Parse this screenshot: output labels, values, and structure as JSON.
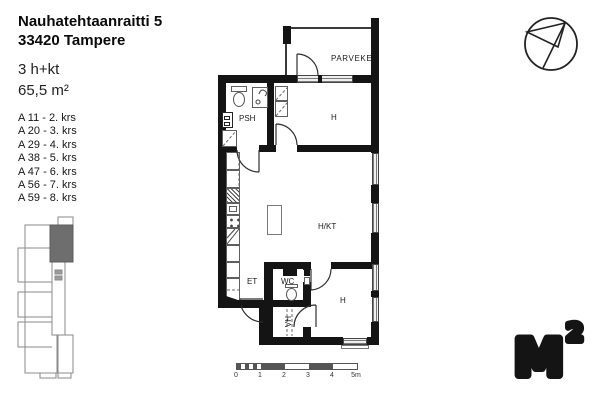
{
  "header": {
    "address_line1": "Nauhatehtaanraitti 5",
    "address_line2": "33420 Tampere",
    "apartment_type": "3 h+kt",
    "area": "65,5 m²"
  },
  "apartment_list": [
    "A 11 - 2. krs",
    "A 20 - 3. krs",
    "A 29 - 4. krs",
    "A 38 - 5. krs",
    "A 47 - 6. krs",
    "A 56 - 7. krs",
    "A 59 - 8. krs"
  ],
  "floor_plan": {
    "rooms": {
      "balcony": "PARVEKE",
      "bedroom_top": "H",
      "bathroom": "PSH",
      "living_kitchen": "H/KT",
      "entry": "ET",
      "toilet": "WC",
      "closet": "VH",
      "bedroom_bottom": "H"
    }
  },
  "scale_bar": {
    "labels": [
      "0",
      "1",
      "2",
      "3",
      "4",
      "5m"
    ]
  },
  "logo": {
    "letter": "M",
    "superscript": "2"
  },
  "colors": {
    "wall": "#141414",
    "highlighted_unit": "#6e6e6e",
    "outline": "#8a8a8a"
  }
}
